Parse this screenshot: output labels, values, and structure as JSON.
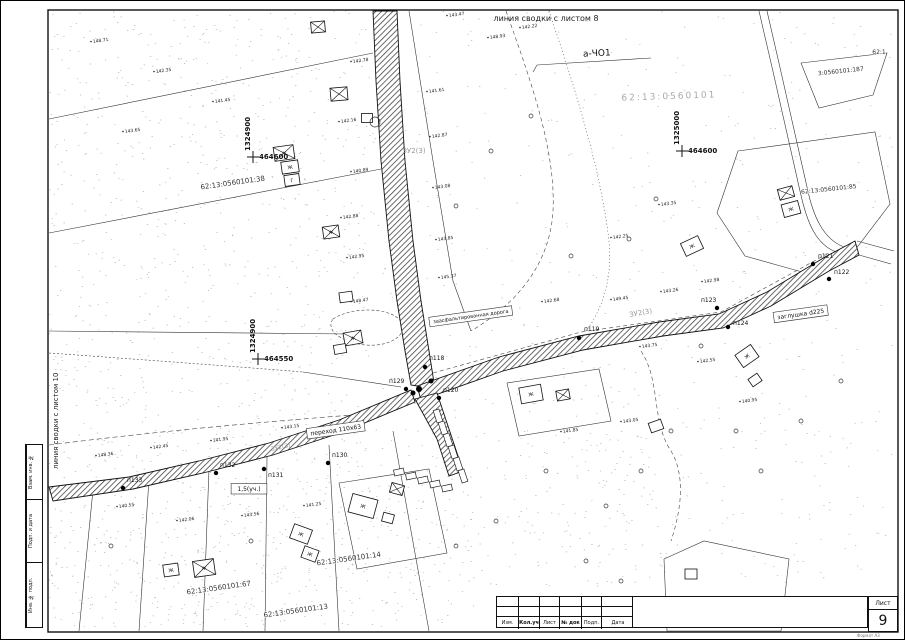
{
  "frame": {
    "stamp_left": {
      "cells": [
        {
          "label": "Взам. инв. №"
        },
        {
          "label": "Подп. и дата"
        },
        {
          "label": "Инв. № подл."
        }
      ]
    },
    "title_block": {
      "columns": [
        {
          "label": "Изм.",
          "bold": false
        },
        {
          "label": "Кол.уч",
          "bold": true
        },
        {
          "label": "Лист",
          "bold": false
        },
        {
          "label": "№ док",
          "bold": true
        },
        {
          "label": "Подп.",
          "bold": false
        },
        {
          "label": "Дата",
          "bold": false
        }
      ],
      "sheet_label": "Лист",
      "sheet_number": "9",
      "format_note": "Формат А3"
    }
  },
  "map": {
    "edge_labels": {
      "top": {
        "text": "линия сводки с листом 8",
        "x": 545,
        "y": 20
      },
      "left": {
        "text": "линия сводки с листом 10",
        "x": 57,
        "y": 468
      }
    },
    "coordinate_crosses": [
      {
        "v": "1324900",
        "h": "464600",
        "x": 252,
        "y": 156
      },
      {
        "v": "1325000",
        "h": "464600",
        "x": 681,
        "y": 150
      },
      {
        "v": "1324900",
        "h": "464550",
        "x": 257,
        "y": 358
      }
    ],
    "cadastral_labels": [
      {
        "text": "62:13:0560101:38",
        "x": 232,
        "y": 184,
        "rot": -8,
        "size": 7,
        "faint": false
      },
      {
        "text": "62:13:0560101",
        "x": 668,
        "y": 98,
        "rot": -2,
        "size": 9,
        "faint": true
      },
      {
        "text": "3:0560101:187",
        "x": 840,
        "y": 72,
        "rot": -6,
        "size": 6,
        "faint": false
      },
      {
        "text": "62:13:0560101:85",
        "x": 828,
        "y": 190,
        "rot": -6,
        "size": 6,
        "faint": false
      },
      {
        "text": "62:1",
        "x": 878,
        "y": 53,
        "rot": 0,
        "size": 6,
        "faint": false
      },
      {
        "text": "62:13:0560101:67",
        "x": 218,
        "y": 589,
        "rot": -8,
        "size": 7,
        "faint": false
      },
      {
        "text": "62:13:0560101:14",
        "x": 348,
        "y": 560,
        "rot": -8,
        "size": 7,
        "faint": false
      },
      {
        "text": "62:13:0560101:13",
        "x": 295,
        "y": 612,
        "rot": -8,
        "size": 7,
        "faint": false
      }
    ],
    "annotations": [
      {
        "text": "а-ЧО1",
        "x": 596,
        "y": 55,
        "size": 9,
        "rot": -3,
        "boxed": false,
        "faint": false
      },
      {
        "text": "ЗУ2(3)",
        "x": 413,
        "y": 152,
        "size": 7,
        "rot": 0,
        "boxed": false,
        "faint": true
      },
      {
        "text": "ЗУ2(3)",
        "x": 640,
        "y": 314,
        "size": 7,
        "rot": -10,
        "boxed": false,
        "faint": true
      },
      {
        "text": "ЗУ2(3)",
        "x": 280,
        "y": 448,
        "size": 6,
        "rot": -12,
        "boxed": false,
        "faint": true
      },
      {
        "text": "заглушка d225",
        "x": 800,
        "y": 315,
        "size": 6,
        "rot": -8,
        "boxed": true,
        "faint": false
      },
      {
        "text": "1,5(уч.)",
        "x": 248,
        "y": 490,
        "size": 6,
        "rot": 0,
        "boxed": true,
        "faint": false
      },
      {
        "text": "переход 110х63",
        "x": 335,
        "y": 431,
        "size": 6,
        "rot": -8,
        "boxed": true,
        "faint": false
      },
      {
        "text": "заасфальтированная дорога",
        "x": 470,
        "y": 317,
        "size": 5,
        "rot": -8,
        "boxed": true,
        "faint": false
      }
    ],
    "survey_points": [
      {
        "id": "п118",
        "x": 424,
        "y": 366,
        "lx": 428,
        "ly": 359
      },
      {
        "id": "п119",
        "x": 578,
        "y": 337,
        "lx": 583,
        "ly": 330
      },
      {
        "id": "п120",
        "x": 438,
        "y": 397,
        "lx": 442,
        "ly": 391
      },
      {
        "id": "п121",
        "x": 812,
        "y": 263,
        "lx": 817,
        "ly": 257
      },
      {
        "id": "п122",
        "x": 828,
        "y": 278,
        "lx": 833,
        "ly": 273
      },
      {
        "id": "п123",
        "x": 716,
        "y": 307,
        "lx": 700,
        "ly": 301
      },
      {
        "id": "п124",
        "x": 727,
        "y": 326,
        "lx": 732,
        "ly": 324
      },
      {
        "id": "п129",
        "x": 405,
        "y": 388,
        "lx": 388,
        "ly": 382
      },
      {
        "id": "п130",
        "x": 327,
        "y": 462,
        "lx": 331,
        "ly": 456
      },
      {
        "id": "п131",
        "x": 263,
        "y": 468,
        "lx": 267,
        "ly": 476
      },
      {
        "id": "п132",
        "x": 215,
        "y": 472,
        "lx": 219,
        "ly": 466
      },
      {
        "id": "п133",
        "x": 122,
        "y": 487,
        "lx": 126,
        "ly": 481
      }
    ],
    "elevations": [
      {
        "t": "143.47",
        "x": 448,
        "y": 16
      },
      {
        "t": "148.93",
        "x": 489,
        "y": 38
      },
      {
        "t": "142.22",
        "x": 521,
        "y": 28
      },
      {
        "t": "142.78",
        "x": 352,
        "y": 62
      },
      {
        "t": "141.61",
        "x": 428,
        "y": 92
      },
      {
        "t": "142.16",
        "x": 340,
        "y": 122
      },
      {
        "t": "142.87",
        "x": 431,
        "y": 137
      },
      {
        "t": "140.89",
        "x": 352,
        "y": 172
      },
      {
        "t": "143.08",
        "x": 434,
        "y": 188
      },
      {
        "t": "142.88",
        "x": 342,
        "y": 218
      },
      {
        "t": "143.85",
        "x": 437,
        "y": 240
      },
      {
        "t": "142.95",
        "x": 348,
        "y": 258
      },
      {
        "t": "145.37",
        "x": 440,
        "y": 278
      },
      {
        "t": "148.47",
        "x": 352,
        "y": 302
      },
      {
        "t": "143.28",
        "x": 458,
        "y": 318
      },
      {
        "t": "142.68",
        "x": 543,
        "y": 302
      },
      {
        "t": "149.45",
        "x": 612,
        "y": 300
      },
      {
        "t": "143.26",
        "x": 662,
        "y": 292
      },
      {
        "t": "142.98",
        "x": 703,
        "y": 282
      },
      {
        "t": "148.36",
        "x": 97,
        "y": 456
      },
      {
        "t": "142.45",
        "x": 152,
        "y": 448
      },
      {
        "t": "141.95",
        "x": 212,
        "y": 441
      },
      {
        "t": "143.15",
        "x": 283,
        "y": 428
      },
      {
        "t": "140.55",
        "x": 118,
        "y": 507
      },
      {
        "t": "142.06",
        "x": 178,
        "y": 521
      },
      {
        "t": "143.56",
        "x": 243,
        "y": 516
      },
      {
        "t": "141.25",
        "x": 305,
        "y": 506
      },
      {
        "t": "143.75",
        "x": 641,
        "y": 347
      },
      {
        "t": "142.55",
        "x": 699,
        "y": 362
      },
      {
        "t": "140.95",
        "x": 741,
        "y": 402
      },
      {
        "t": "143.05",
        "x": 622,
        "y": 422
      },
      {
        "t": "141.85",
        "x": 562,
        "y": 432
      },
      {
        "t": "148.71",
        "x": 92,
        "y": 42
      },
      {
        "t": "142.35",
        "x": 155,
        "y": 72
      },
      {
        "t": "141.45",
        "x": 214,
        "y": 102
      },
      {
        "t": "143.65",
        "x": 124,
        "y": 132
      },
      {
        "t": "142.25",
        "x": 612,
        "y": 238
      },
      {
        "t": "143.35",
        "x": 660,
        "y": 205
      }
    ],
    "buildings": [
      {
        "x": 317,
        "y": 26,
        "w": 14,
        "h": 11,
        "r": -5,
        "cross": 1,
        "label": ""
      },
      {
        "x": 338,
        "y": 93,
        "w": 17,
        "h": 13,
        "r": -5,
        "cross": 1,
        "label": ""
      },
      {
        "x": 283,
        "y": 152,
        "w": 20,
        "h": 14,
        "r": -8,
        "cross": 1,
        "label": "Ж"
      },
      {
        "x": 289,
        "y": 166,
        "w": 17,
        "h": 12,
        "r": -8,
        "cross": 0,
        "label": "Ж"
      },
      {
        "x": 291,
        "y": 179,
        "w": 15,
        "h": 11,
        "r": -8,
        "cross": 0,
        "label": "Г"
      },
      {
        "x": 330,
        "y": 231,
        "w": 16,
        "h": 12,
        "r": -8,
        "cross": 1,
        "label": "Ж"
      },
      {
        "x": 345,
        "y": 296,
        "w": 13,
        "h": 10,
        "r": -8,
        "cross": 0,
        "label": ""
      },
      {
        "x": 352,
        "y": 337,
        "w": 18,
        "h": 13,
        "r": -10,
        "cross": 1,
        "label": "Ж"
      },
      {
        "x": 339,
        "y": 348,
        "w": 12,
        "h": 9,
        "r": -10,
        "cross": 0,
        "label": ""
      },
      {
        "x": 366,
        "y": 117,
        "w": 11,
        "h": 9,
        "r": 0,
        "cross": 0,
        "label": ""
      },
      {
        "x": 170,
        "y": 569,
        "w": 15,
        "h": 12,
        "r": -8,
        "cross": 0,
        "label": "Ж"
      },
      {
        "x": 203,
        "y": 567,
        "w": 21,
        "h": 16,
        "r": -8,
        "cross": 1,
        "label": "Ж"
      },
      {
        "x": 300,
        "y": 533,
        "w": 19,
        "h": 15,
        "r": 20,
        "cross": 0,
        "label": "Ж"
      },
      {
        "x": 309,
        "y": 553,
        "w": 15,
        "h": 12,
        "r": 20,
        "cross": 0,
        "label": "Ж"
      },
      {
        "x": 362,
        "y": 505,
        "w": 26,
        "h": 19,
        "r": 15,
        "cross": 0,
        "label": "Ж"
      },
      {
        "x": 387,
        "y": 517,
        "w": 11,
        "h": 9,
        "r": 15,
        "cross": 0,
        "label": ""
      },
      {
        "x": 396,
        "y": 488,
        "w": 13,
        "h": 10,
        "r": 15,
        "cross": 1,
        "label": ""
      },
      {
        "x": 530,
        "y": 393,
        "w": 22,
        "h": 16,
        "r": -10,
        "cross": 0,
        "label": "Ж"
      },
      {
        "x": 562,
        "y": 394,
        "w": 13,
        "h": 10,
        "r": -10,
        "cross": 1,
        "label": ""
      },
      {
        "x": 691,
        "y": 245,
        "w": 19,
        "h": 14,
        "r": -25,
        "cross": 0,
        "label": "Ж"
      },
      {
        "x": 785,
        "y": 192,
        "w": 15,
        "h": 11,
        "r": -15,
        "cross": 1,
        "label": ""
      },
      {
        "x": 790,
        "y": 208,
        "w": 17,
        "h": 13,
        "r": -15,
        "cross": 0,
        "label": "Ж"
      },
      {
        "x": 746,
        "y": 355,
        "w": 19,
        "h": 15,
        "r": -35,
        "cross": 0,
        "label": "Ж"
      },
      {
        "x": 754,
        "y": 379,
        "w": 11,
        "h": 9,
        "r": -35,
        "cross": 0,
        "label": ""
      },
      {
        "x": 655,
        "y": 425,
        "w": 13,
        "h": 10,
        "r": -20,
        "cross": 0,
        "label": ""
      },
      {
        "x": 690,
        "y": 573,
        "w": 12,
        "h": 10,
        "r": 0,
        "cross": 0,
        "label": ""
      }
    ],
    "circles": [
      [
        374,
        121,
        5
      ],
      [
        455,
        205,
        2
      ],
      [
        490,
        150,
        2
      ],
      [
        530,
        115,
        2
      ],
      [
        570,
        255,
        2
      ],
      [
        628,
        238,
        2
      ],
      [
        655,
        198,
        2
      ],
      [
        700,
        345,
        2
      ],
      [
        735,
        430,
        2
      ],
      [
        640,
        470,
        2
      ],
      [
        605,
        505,
        2
      ],
      [
        670,
        430,
        2
      ],
      [
        455,
        545,
        2
      ],
      [
        495,
        520,
        2
      ],
      [
        110,
        545,
        2
      ],
      [
        250,
        540,
        2
      ],
      [
        545,
        470,
        2
      ],
      [
        585,
        560,
        2
      ],
      [
        620,
        580,
        2
      ],
      [
        760,
        470,
        2
      ],
      [
        800,
        420,
        2
      ],
      [
        840,
        380,
        2
      ]
    ]
  }
}
